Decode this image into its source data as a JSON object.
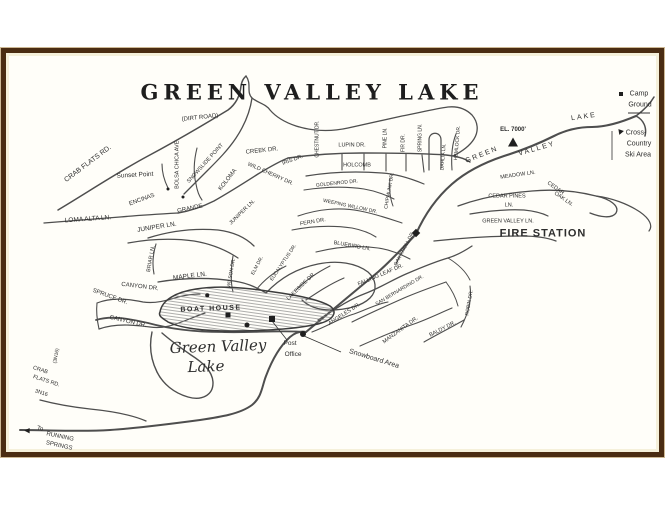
{
  "title": "GREEN VALLEY LAKE",
  "colors": {
    "frame_border": "#4a2c12",
    "frame_mat": "#f5f0da",
    "road": "#454545",
    "ink": "#2d2d2d",
    "paper": "#fffef9"
  },
  "map": {
    "labels": [
      {
        "t": "CRAB FLATS RD.",
        "x": 88,
        "y": 164,
        "r": -37,
        "s": 7
      },
      {
        "t": "(DIRT ROAD)",
        "x": 200,
        "y": 118,
        "r": -6,
        "s": 6
      },
      {
        "t": "Sunset Point",
        "x": 135,
        "y": 176,
        "r": -3,
        "s": 6.5
      },
      {
        "t": "BOLSA CHICA AVE.",
        "x": 178,
        "y": 164,
        "r": -90,
        "s": 5.5
      },
      {
        "t": "SNOWSLIDE POINT",
        "x": 206,
        "y": 164,
        "r": -48,
        "s": 5.5
      },
      {
        "t": "KOLOMA",
        "x": 228,
        "y": 180,
        "r": -52,
        "s": 6
      },
      {
        "t": "LOMA ALTA LN.",
        "x": 88,
        "y": 220,
        "r": -4,
        "s": 6.5
      },
      {
        "t": "ENCINAS",
        "x": 142,
        "y": 200,
        "r": -20,
        "s": 6
      },
      {
        "t": "GRANDE",
        "x": 190,
        "y": 209,
        "r": -12,
        "s": 6
      },
      {
        "t": "JUNIPER LN.",
        "x": 157,
        "y": 228,
        "r": -9,
        "s": 6.5
      },
      {
        "t": "JUNIPER LN.",
        "x": 243,
        "y": 213,
        "r": -44,
        "s": 5.5
      },
      {
        "t": "BRIAR LN.",
        "x": 152,
        "y": 259,
        "r": -80,
        "s": 5.5
      },
      {
        "t": "MAPLE LN.",
        "x": 190,
        "y": 277,
        "r": -7,
        "s": 6.5
      },
      {
        "t": "SPRUCE DR.",
        "x": 110,
        "y": 297,
        "r": 20,
        "s": 6
      },
      {
        "t": "CANYON DR.",
        "x": 140,
        "y": 287,
        "r": 7,
        "s": 6
      },
      {
        "t": "CANYON DR.",
        "x": 128,
        "y": 322,
        "r": 13,
        "s": 6
      },
      {
        "t": "BOAT HOUSE",
        "x": 211,
        "y": 309,
        "r": -2,
        "s": 7,
        "b": 1,
        "ls": 1.5
      },
      {
        "t": "Green Valley",
        "x": 218,
        "y": 347,
        "r": -2,
        "s": 15,
        "i": 1,
        "f": "serif"
      },
      {
        "t": "Lake",
        "x": 206,
        "y": 367,
        "r": -2,
        "s": 15,
        "i": 1,
        "f": "serif"
      },
      {
        "t": "Post",
        "x": 290,
        "y": 344,
        "s": 6.5
      },
      {
        "t": "Office",
        "x": 293,
        "y": 355,
        "s": 6.5
      },
      {
        "t": "Snowboard Area",
        "x": 374,
        "y": 359,
        "r": 17,
        "s": 7
      },
      {
        "t": "CRAB",
        "x": 40,
        "y": 371,
        "r": 18,
        "s": 5.5
      },
      {
        "t": "FLATS RD.",
        "x": 46,
        "y": 382,
        "r": 18,
        "s": 5.5
      },
      {
        "t": "3N16",
        "x": 41,
        "y": 394,
        "r": 18,
        "s": 5.5
      },
      {
        "t": "(3N16)",
        "x": 57,
        "y": 356,
        "r": -80,
        "s": 5
      },
      {
        "t": "To",
        "x": 40,
        "y": 429,
        "r": 12,
        "s": 6
      },
      {
        "t": "RUNNING",
        "x": 60,
        "y": 437,
        "r": 12,
        "s": 6
      },
      {
        "t": "SPRINGS",
        "x": 59,
        "y": 446,
        "r": 12,
        "s": 6
      },
      {
        "t": "CREEK DR.",
        "x": 262,
        "y": 151,
        "r": -6,
        "s": 6
      },
      {
        "t": "IRIS DR.",
        "x": 293,
        "y": 161,
        "r": -20,
        "s": 5.5
      },
      {
        "t": "WILD CHERRY DR.",
        "x": 270,
        "y": 175,
        "r": 24,
        "s": 5.5
      },
      {
        "t": "CHESTNUT DR.",
        "x": 318,
        "y": 139,
        "r": -90,
        "s": 5
      },
      {
        "t": "LUPIN DR.",
        "x": 352,
        "y": 146,
        "s": 5.5
      },
      {
        "t": "HOLCOMB",
        "x": 357,
        "y": 166,
        "s": 5.5
      },
      {
        "t": "PINE LN.",
        "x": 386,
        "y": 138,
        "r": -90,
        "s": 5
      },
      {
        "t": "FIR DR.",
        "x": 404,
        "y": 143,
        "r": -90,
        "s": 5
      },
      {
        "t": "SPRING LN.",
        "x": 421,
        "y": 138,
        "r": -90,
        "s": 5
      },
      {
        "t": "HEMLOCK DR.",
        "x": 458,
        "y": 143,
        "r": -85,
        "s": 5
      },
      {
        "t": "DAHLIA LN.",
        "x": 444,
        "y": 157,
        "r": -85,
        "s": 5
      },
      {
        "t": "GOLDENROD DR.",
        "x": 337,
        "y": 184,
        "r": -6,
        "s": 5
      },
      {
        "t": "CHIPMUNK DR.",
        "x": 390,
        "y": 191,
        "r": -80,
        "s": 5
      },
      {
        "t": "WEEPING WILLOW DR.",
        "x": 350,
        "y": 207,
        "r": 12,
        "s": 5
      },
      {
        "t": "FERN DR.",
        "x": 313,
        "y": 223,
        "r": -10,
        "s": 5.5
      },
      {
        "t": "BLUEBIRD LN.",
        "x": 352,
        "y": 247,
        "r": 10,
        "s": 5.5
      },
      {
        "t": "OAK KNOLL DR.",
        "x": 405,
        "y": 249,
        "r": -62,
        "s": 5
      },
      {
        "t": "GREEN",
        "x": 482,
        "y": 155,
        "r": -22,
        "s": 7,
        "ls": 2
      },
      {
        "t": "VALLEY",
        "x": 537,
        "y": 149,
        "r": -16,
        "s": 7,
        "ls": 2
      },
      {
        "t": "LAKE",
        "x": 584,
        "y": 117,
        "r": -8,
        "s": 7,
        "ls": 2
      },
      {
        "t": "EL. 7000'",
        "x": 513,
        "y": 130,
        "s": 6,
        "b": 1
      },
      {
        "t": "Camp",
        "x": 639,
        "y": 94,
        "s": 7
      },
      {
        "t": "Ground",
        "x": 640,
        "y": 105,
        "s": 7
      },
      {
        "t": "Cross-",
        "x": 636,
        "y": 133,
        "s": 7
      },
      {
        "t": "Country",
        "x": 639,
        "y": 144,
        "s": 7
      },
      {
        "t": "Ski Area",
        "x": 638,
        "y": 155,
        "s": 7
      },
      {
        "t": "MEADOW LN.",
        "x": 518,
        "y": 176,
        "r": -8,
        "s": 5.5
      },
      {
        "t": "CEDAR PINES",
        "x": 507,
        "y": 197,
        "s": 5.5
      },
      {
        "t": "LN.",
        "x": 509,
        "y": 206,
        "s": 5.5
      },
      {
        "t": "CEDAR",
        "x": 555,
        "y": 189,
        "r": 35,
        "s": 5.5
      },
      {
        "t": "OAK LN.",
        "x": 563,
        "y": 200,
        "r": 35,
        "s": 5.5
      },
      {
        "t": "GREEN VALLEY LN.",
        "x": 508,
        "y": 222,
        "s": 5.5
      },
      {
        "t": "FIRE STATION",
        "x": 543,
        "y": 234,
        "s": 11,
        "b": 1,
        "ls": 1
      },
      {
        "t": "FALLING LEAF DR.",
        "x": 381,
        "y": 276,
        "r": -23,
        "s": 5.5
      },
      {
        "t": "ANGELES DR.",
        "x": 345,
        "y": 315,
        "r": -33,
        "s": 5.5
      },
      {
        "t": "SAN BERNARDINO DR.",
        "x": 400,
        "y": 291,
        "r": -31,
        "s": 5
      },
      {
        "t": "MANZANITA DR.",
        "x": 401,
        "y": 331,
        "r": -36,
        "s": 5.5
      },
      {
        "t": "BALDY DR.",
        "x": 443,
        "y": 330,
        "r": -27,
        "s": 5.5
      },
      {
        "t": "ROBIN DR.",
        "x": 470,
        "y": 303,
        "r": -80,
        "s": 5
      },
      {
        "t": "LAKESIDE DR.",
        "x": 302,
        "y": 287,
        "r": -44,
        "s": 5.5
      },
      {
        "t": "EUCALYPTUS DR.",
        "x": 284,
        "y": 263,
        "r": -56,
        "s": 5
      },
      {
        "t": "ELM DR.",
        "x": 258,
        "y": 266,
        "r": -62,
        "s": 5
      },
      {
        "t": "WILSON DR.",
        "x": 232,
        "y": 273,
        "r": -80,
        "s": 5
      }
    ],
    "markers": [
      {
        "type": "dot",
        "x": 168,
        "y": 189,
        "s": 3
      },
      {
        "type": "dot",
        "x": 183,
        "y": 197,
        "s": 3
      },
      {
        "type": "dot",
        "x": 207,
        "y": 295,
        "s": 3.5
      },
      {
        "type": "square",
        "x": 228,
        "y": 315,
        "s": 5
      },
      {
        "type": "dot",
        "x": 247,
        "y": 325,
        "s": 5
      },
      {
        "type": "square",
        "x": 272,
        "y": 319,
        "s": 6
      },
      {
        "type": "dot",
        "x": 303,
        "y": 334,
        "s": 6
      },
      {
        "type": "diamond",
        "x": 416,
        "y": 233,
        "s": 6
      },
      {
        "type": "triangle",
        "x": 513,
        "y": 142,
        "s": 9
      },
      {
        "type": "square",
        "x": 621,
        "y": 94,
        "s": 4
      },
      {
        "type": "triangle",
        "x": 620,
        "y": 131,
        "s": 5,
        "r": -40
      },
      {
        "type": "arrow-left",
        "x": 27,
        "y": 431,
        "s": 7
      }
    ]
  }
}
